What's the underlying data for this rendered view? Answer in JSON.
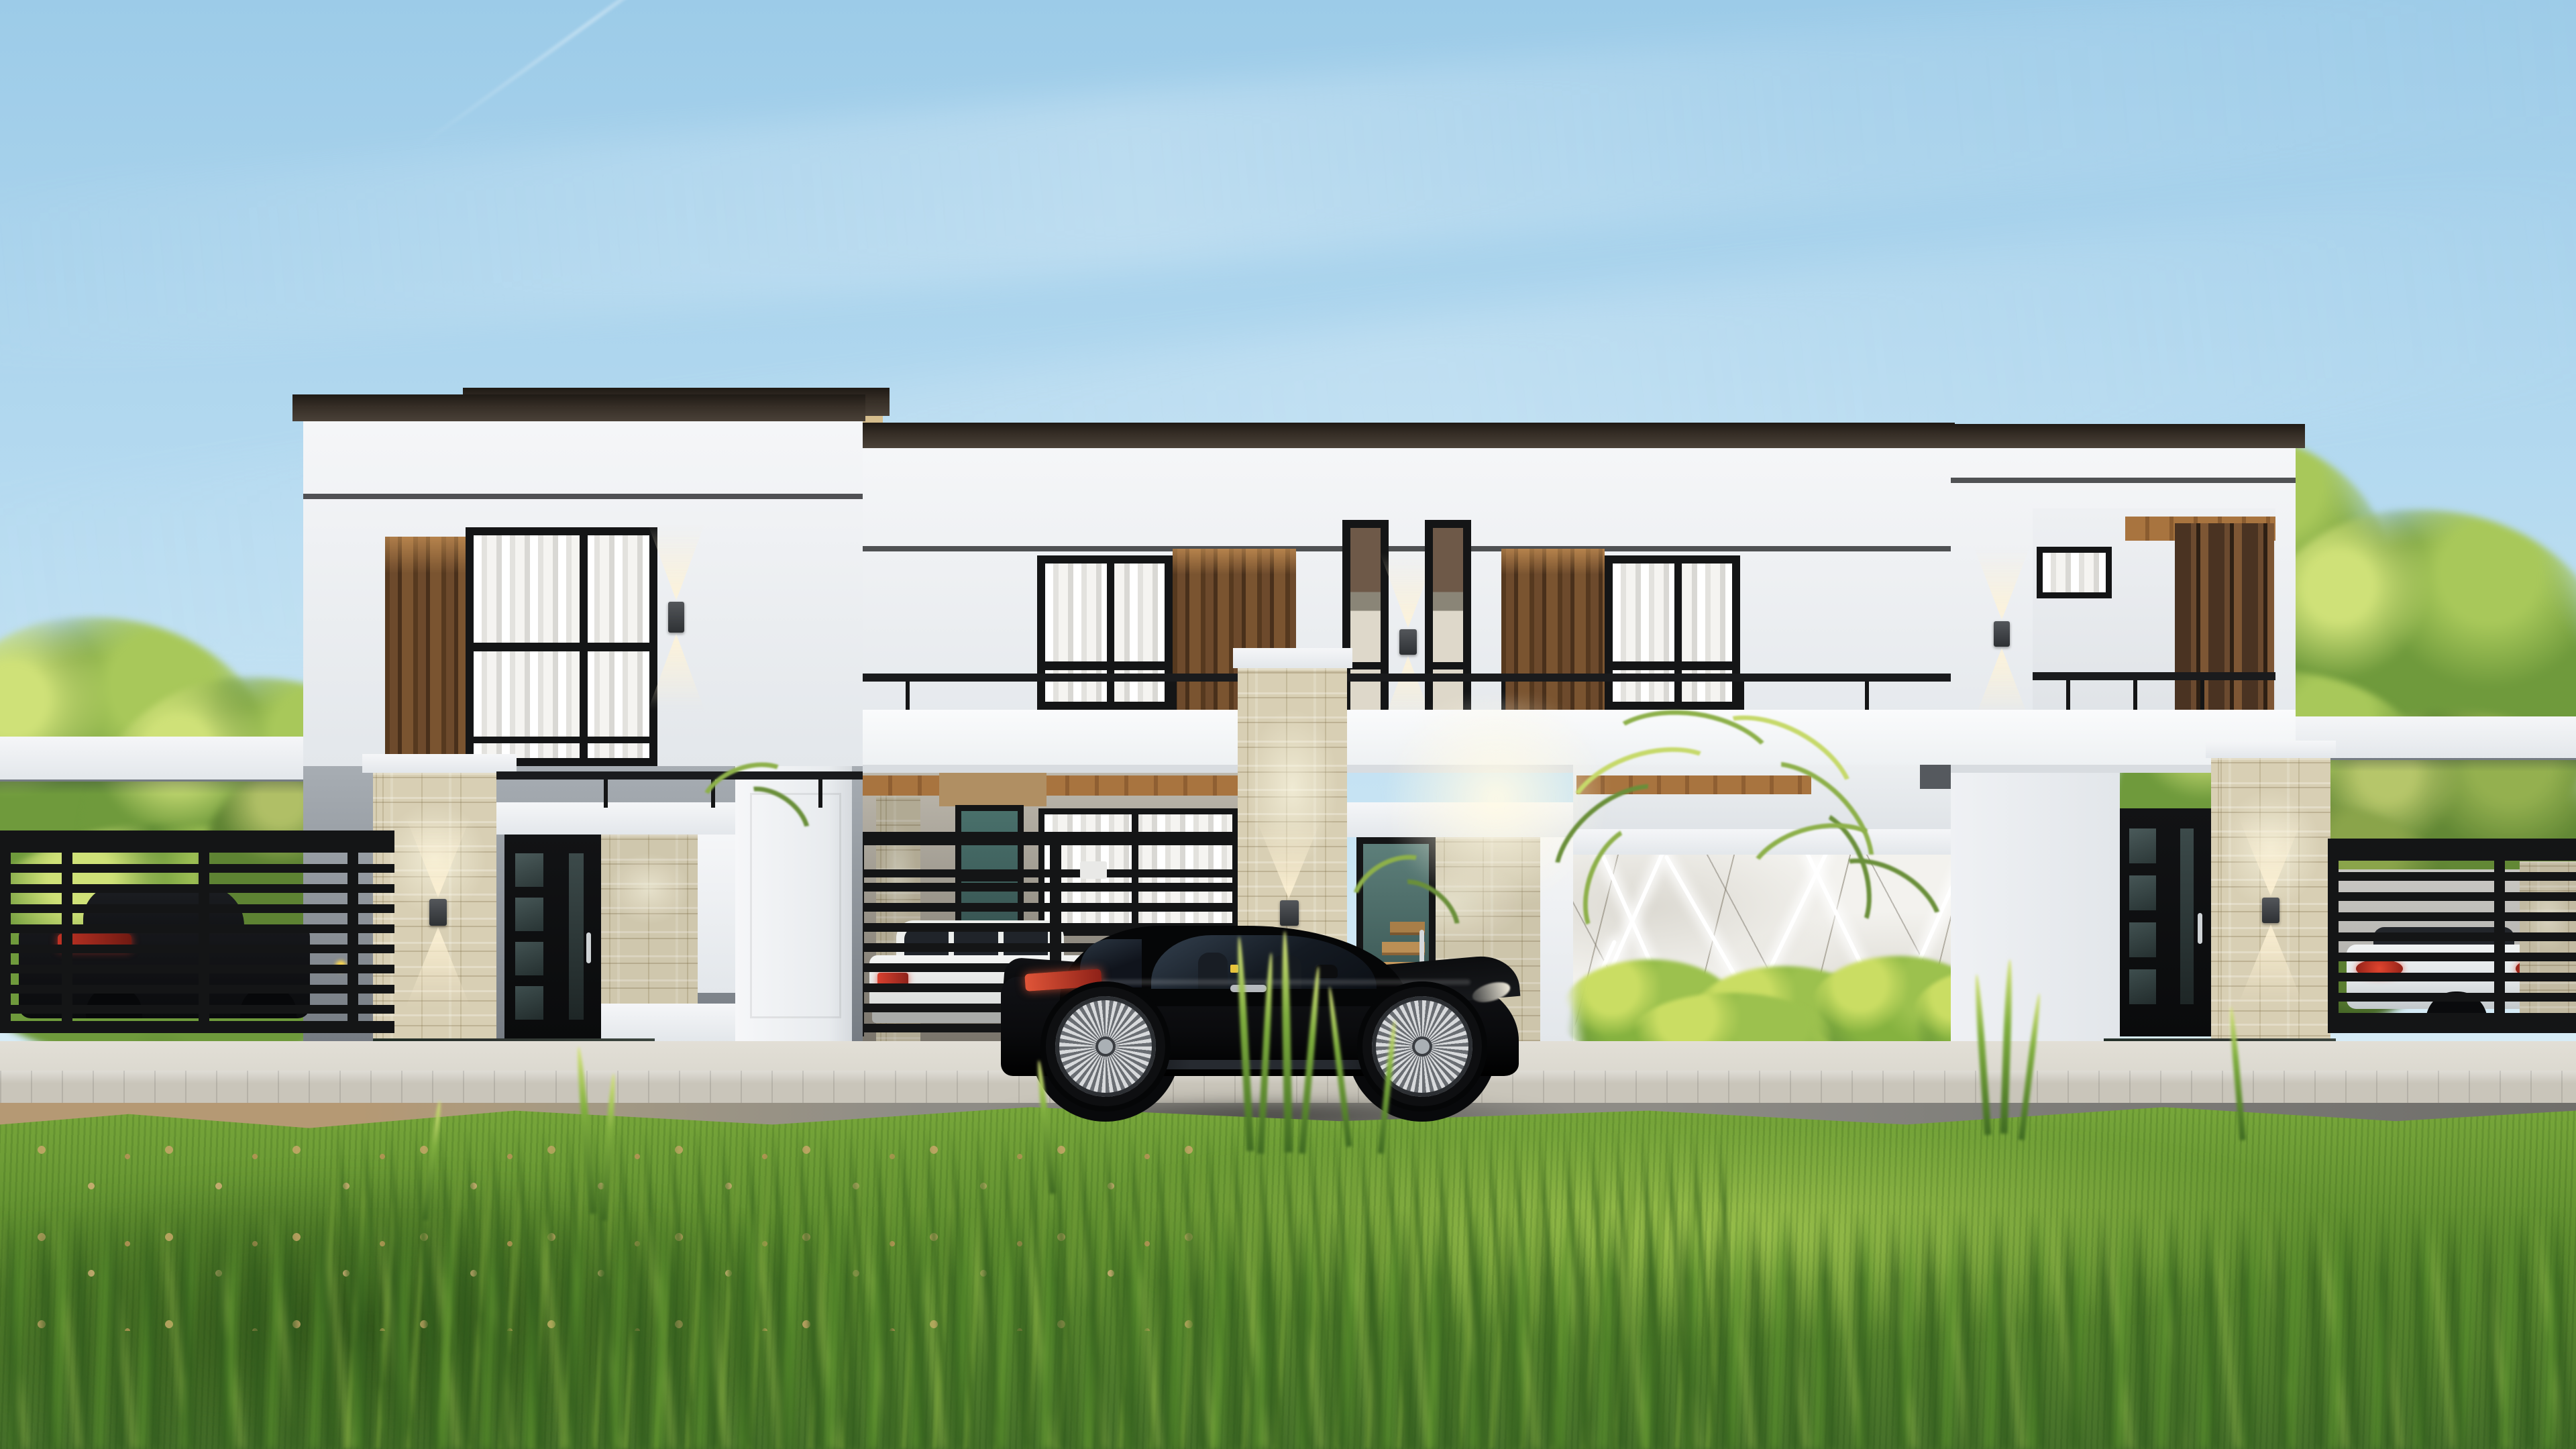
{
  "scene": {
    "label": "modern-duplex-house-exterior-render",
    "objects": [
      "sky",
      "cloud-streaks",
      "jet-contrail",
      "tree-clusters",
      "flat-roof-duplex-house",
      "left-tower",
      "right-tower",
      "center-upper-windows",
      "narrow-slot-windows",
      "wood-accent-panels",
      "wood-louver-screen",
      "balcony-railing",
      "stone-clad-pillars",
      "wall-sconces-glowing",
      "carport-gate-black-slats",
      "entry-doors-black-glass",
      "glass-stair-door",
      "marble-wall-with-led-strips",
      "hedge-bushes",
      "palm-plants",
      "perimeter-black-slat-fence",
      "parked-dark-sedan",
      "parked-white-suv",
      "parked-white-car",
      "black-sports-coupe",
      "silver-multispoke-wheels",
      "paver-curb",
      "asphalt-road",
      "lawn-with-fallen-leaves",
      "blurred-foreground-grass"
    ]
  },
  "palette": {
    "skyTop": "#9ccbe8",
    "skyMid": "#b5daf0",
    "skyLow": "#d9edf7",
    "white": "#f5f6f8",
    "whiteShade": "#e3e7eb",
    "soffitShadow": "#c7ccd2",
    "roofDark": "#362e26",
    "soffitTan": "#d5bd8d",
    "woodDark": "#56391f",
    "woodHi": "#c08a4e",
    "stoneBase": "#d8cfb4",
    "stoneMortar": "#b7ac8e",
    "marble": "#f3f2ee",
    "marbleVein": "#a9a195",
    "frameBlack": "#141516",
    "railBlack": "#1a1b1d",
    "tealGlass": "#49706b",
    "tealGlassDark": "#35514f",
    "glowWarm": "#fff3d6",
    "treeSun": "#cfe178",
    "treeLight": "#a8c85a",
    "treeGreen": "#6f9a3c",
    "treeMid": "#5d8834",
    "treeDark": "#3c6124",
    "palmLight": "#c6d96a",
    "palmGreen": "#8db04a",
    "palmDark": "#6a8f3a",
    "bushGreen": "#6f9c3b",
    "bushYellow": "#cadd63",
    "grassTip": "#d8e57e",
    "roadGray": "#8e8c86",
    "roadTan": "#b59974",
    "curb": "#c9c5ba",
    "walkway": "#dcd9d0",
    "carBlack": "#0a0b0d",
    "carRefl": "#2a2d33",
    "rimSilver": "#d8dadc",
    "rimDark": "#6a6e73",
    "tailRed": "#c43a2e",
    "sedanDark": "#17181c",
    "suvWhite": "#eceeec",
    "carWhite": "#e0e4e6",
    "concrete": "#b5b4b0",
    "plinthDark": "#2e3430"
  }
}
